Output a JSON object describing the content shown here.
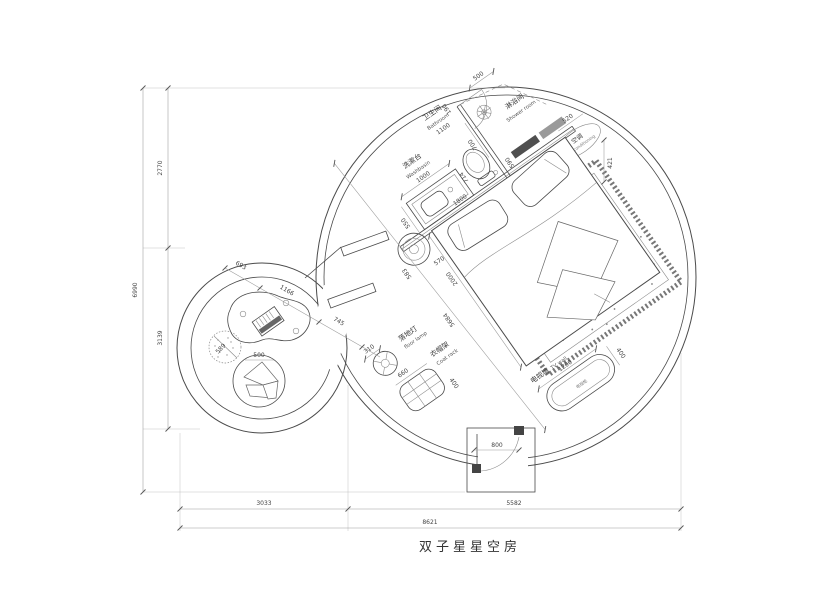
{
  "title": "双子星星空房",
  "dims": {
    "total_h": "6990",
    "seg_top": "2770",
    "seg_bottom": "3139",
    "bottom_seg1": "3033",
    "bottom_seg2": "5582",
    "total_w": "8621",
    "d190": "190",
    "d700": "700",
    "d500": "500",
    "d590": "590",
    "d550": "550",
    "d1000": "1000",
    "d1100": "1100",
    "d714": "714",
    "d1800": "1800",
    "d520": "520",
    "d421": "421",
    "d583": "583",
    "d570": "570",
    "d2000": "2000",
    "d5684": "5684",
    "d310": "310",
    "d660": "660",
    "d400_coat": "400",
    "d1200": "1200",
    "d400_tv": "400",
    "d800": "800",
    "d693": "693",
    "d1166": "1166",
    "d745": "745",
    "d589": "589",
    "d500_chair": "500"
  },
  "labels": {
    "washbasin_cn": "洗漱台",
    "washbasin_en": "Washbasin",
    "bathroom_cn": "卫生间",
    "bathroom_en": "Bathroom",
    "shower_cn": "淋浴间",
    "shower_en": "Shower room",
    "ac_cn": "空调",
    "ac_en": "air conditioning",
    "floorlamp_cn": "落地灯",
    "floorlamp_en": "floor lamp",
    "coatrack_cn": "衣帽架",
    "coatrack_en": "Coat rack",
    "tvwall_cn": "电视墙",
    "tvwall_en": "TV wall",
    "tvcabinet": "电视柜"
  }
}
